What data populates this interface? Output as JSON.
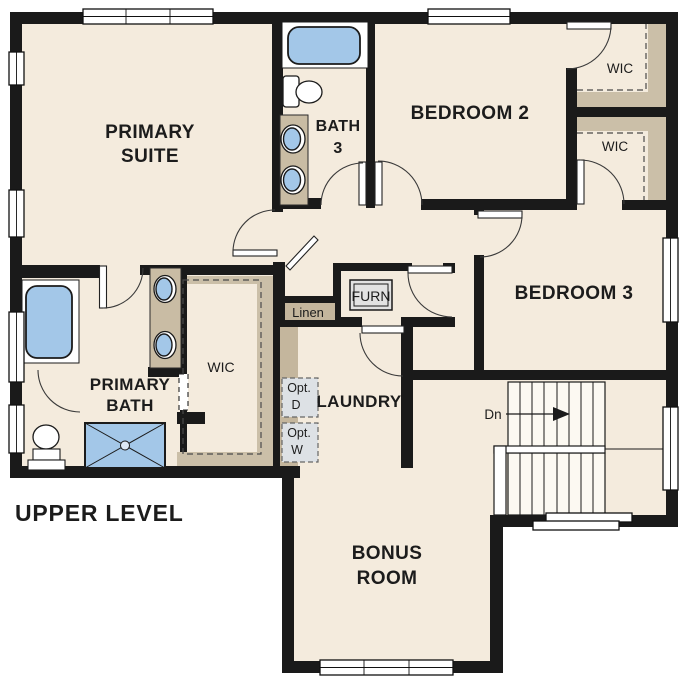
{
  "plan": {
    "title": "UPPER LEVEL",
    "type": "floor-plan",
    "level": "upper"
  },
  "rooms": {
    "primary_suite": {
      "lines": [
        "PRIMARY",
        "SUITE"
      ]
    },
    "bath3": {
      "lines": [
        "BATH",
        "3"
      ]
    },
    "bedroom2": {
      "label": "BEDROOM 2"
    },
    "bedroom3": {
      "label": "BEDROOM 3"
    },
    "wic_bedroom2": {
      "label": "WIC"
    },
    "wic_bedroom3": {
      "label": "WIC"
    },
    "wic_primary": {
      "label": "WIC"
    },
    "primary_bath": {
      "lines": [
        "PRIMARY",
        "BATH"
      ]
    },
    "laundry": {
      "label": "LAUNDRY"
    },
    "bonus_room": {
      "lines": [
        "BONUS",
        "ROOM"
      ]
    },
    "linen": {
      "label": "Linen"
    },
    "furnace": {
      "label": "FURN"
    },
    "opt_dryer": {
      "lines": [
        "Opt.",
        "D"
      ]
    },
    "opt_washer": {
      "lines": [
        "Opt.",
        "W"
      ]
    },
    "stairs": {
      "down_label": "Dn"
    }
  },
  "colors": {
    "wall": "#1a1a1a",
    "floor": "#f4ebdd",
    "counter_tan": "#c9bca4",
    "closet_shelf_tan": "#c4b69d",
    "fixture_blue": "#a3c7e8",
    "option_box_gray": "#dde1e5",
    "furnace_gray": "#e2e2e2",
    "exterior": "#ffffff"
  }
}
